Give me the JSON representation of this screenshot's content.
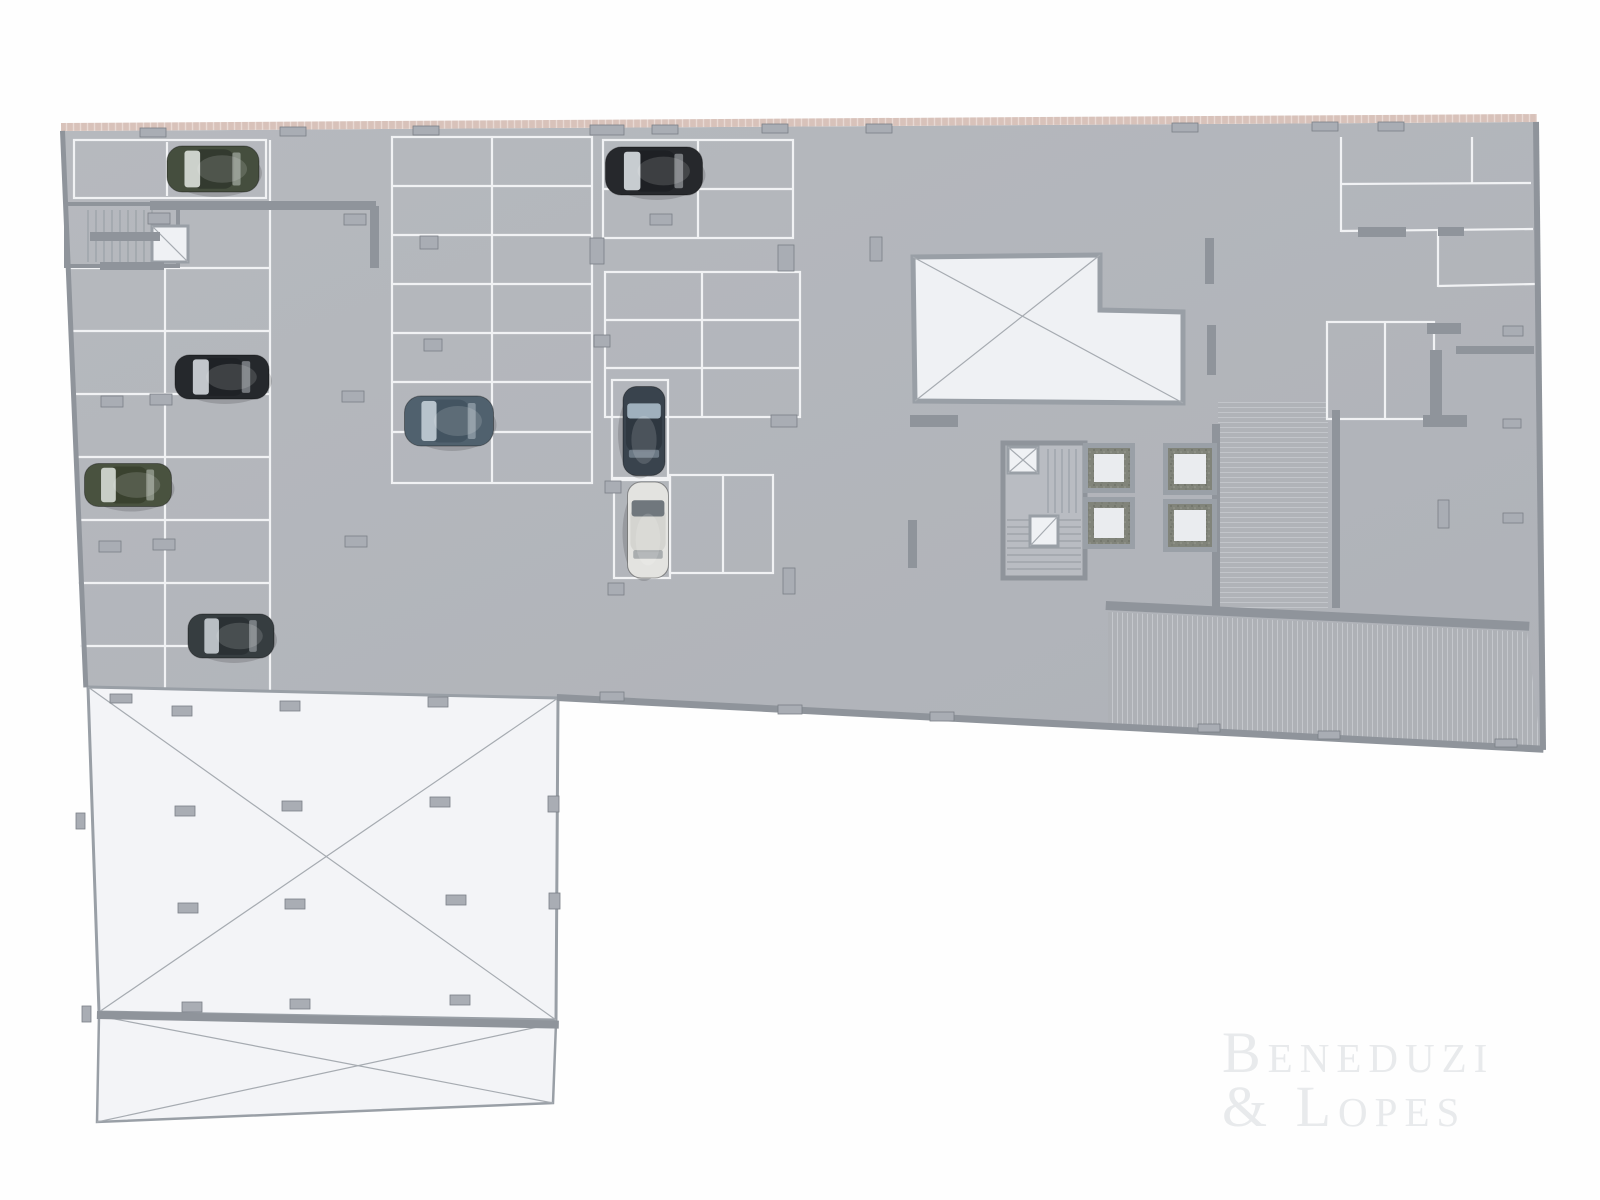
{
  "watermark": {
    "line1": "Beneduzi",
    "line2": "& Lopes"
  },
  "colors": {
    "line": "#f1f2f4",
    "wall": "#8f949b",
    "stub_fill": "#a9adb4",
    "stub_stroke": "#7a7f86",
    "diag": "#a6abb1",
    "void_fill": "#eff1f4",
    "void_stroke": "#999fa6",
    "panel_fill": "#f3f4f7",
    "tread": "#9aa0a6",
    "elevator_wall": "#9aa0a7",
    "elevator_floor": "#eaecef",
    "perimeter_pink": "#d8c2ba",
    "watermark_gray": "#e8eaec"
  },
  "plan": {
    "floor": "62,131 1534,122 1541,749 557,697 85,686",
    "topwall": [
      61,
      123,
      1476,
      8,
      -0.35
    ],
    "bands": [
      {
        "p": "1108,612 1527,632 1541,749 1108,725",
        "pat": "hatchV"
      },
      {
        "p": "1218,402 1328,402 1328,610 1218,610",
        "pat": "hatchH"
      }
    ],
    "lines": [
      [
        167,
        142,
        167,
        196
      ],
      [
        270,
        140,
        270,
        690
      ],
      [
        165,
        268,
        165,
        690
      ],
      [
        68,
        268,
        270,
        268
      ],
      [
        70,
        331,
        270,
        331
      ],
      [
        72,
        394,
        270,
        394
      ],
      [
        74,
        457,
        270,
        457
      ],
      [
        76,
        520,
        270,
        520
      ],
      [
        78,
        583,
        270,
        583
      ],
      [
        80,
        646,
        270,
        646
      ],
      [
        492,
        137,
        492,
        483
      ],
      [
        392,
        186,
        592,
        186
      ],
      [
        392,
        235,
        592,
        235
      ],
      [
        392,
        284,
        592,
        284
      ],
      [
        392,
        333,
        592,
        333
      ],
      [
        392,
        382,
        592,
        382
      ],
      [
        392,
        432,
        592,
        432
      ],
      [
        698,
        140,
        698,
        238
      ],
      [
        603,
        189,
        793,
        189
      ],
      [
        702,
        272,
        702,
        417
      ],
      [
        605,
        320,
        800,
        320
      ],
      [
        605,
        368,
        800,
        368
      ],
      [
        723,
        475,
        723,
        573
      ],
      [
        1341,
        137,
        1341,
        232
      ],
      [
        1472,
        137,
        1472,
        184
      ],
      [
        1341,
        184,
        1531,
        183
      ],
      [
        1341,
        231,
        1533,
        229
      ],
      [
        1438,
        231,
        1438,
        287
      ],
      [
        1438,
        286,
        1535,
        284
      ],
      [
        1385,
        322,
        1385,
        419
      ]
    ],
    "stalls": [
      [
        74,
        140,
        192,
        58
      ],
      [
        392,
        137,
        200,
        346
      ],
      [
        603,
        140,
        190,
        98
      ],
      [
        605,
        272,
        195,
        145
      ],
      [
        612,
        380,
        56,
        100
      ],
      [
        614,
        478,
        56,
        100
      ],
      [
        670,
        475,
        103,
        98
      ],
      [
        1327,
        322,
        107,
        97
      ]
    ],
    "rooms": [
      {
        "r": [
          66,
          204,
          112,
          62
        ],
        "sw": 4,
        "fill": "none"
      },
      {
        "r": [
          1003,
          443,
          82,
          135
        ],
        "sw": 5,
        "fill": "#b9bcc2"
      }
    ],
    "treads": [
      {
        "x": 88,
        "y": 210,
        "step": 8,
        "count": 9,
        "dir": "v",
        "len": 52
      },
      {
        "x": 1007,
        "y": 520,
        "step": 7,
        "count": 8,
        "dir": "h",
        "len": 74
      },
      {
        "x": 1048,
        "y": 449,
        "step": 7,
        "count": 5,
        "dir": "v",
        "len": 64
      }
    ],
    "voids": [
      {
        "p": "913,257 1100,255 1100,310 1183,312 1183,403 915,401",
        "sw": 5,
        "d": [
          [
            913,
            257,
            1183,
            403
          ],
          [
            1100,
            255,
            915,
            401
          ]
        ]
      },
      {
        "p": "152,226 188,226 188,262 152,262",
        "sw": 3,
        "d": [
          [
            152,
            226,
            188,
            262
          ]
        ]
      },
      {
        "p": "1008,447 1038,447 1038,473 1008,473",
        "sw": 3,
        "d": [
          [
            1008,
            447,
            1038,
            473
          ],
          [
            1038,
            447,
            1008,
            473
          ]
        ]
      },
      {
        "p": "1030,516 1058,516 1058,546 1030,546",
        "sw": 3,
        "d": [
          [
            1030,
            546,
            1058,
            516
          ]
        ]
      }
    ],
    "panels": [
      {
        "p": "88,687 558,698 556,1020 99,1012",
        "sw": 3,
        "d": [
          [
            88,
            687,
            556,
            1020
          ],
          [
            558,
            698,
            99,
            1012
          ]
        ]
      },
      {
        "p": "99,1016 556,1023 553,1103 97,1122",
        "sw": 2.5,
        "d": [
          [
            99,
            1016,
            553,
            1103
          ],
          [
            556,
            1023,
            97,
            1122
          ]
        ]
      }
    ],
    "walls": [
      [
        1358,
        227,
        48,
        10
      ],
      [
        1438,
        227,
        26,
        9
      ],
      [
        1427,
        323,
        34,
        11
      ],
      [
        1456,
        346,
        78,
        8
      ],
      [
        1430,
        350,
        12,
        70
      ],
      [
        1423,
        415,
        44,
        12
      ],
      [
        1205,
        238,
        9,
        46
      ],
      [
        1207,
        325,
        9,
        50
      ],
      [
        910,
        415,
        48,
        12
      ],
      [
        908,
        520,
        9,
        48
      ],
      [
        1106,
        601,
        424,
        9,
        2.8
      ],
      [
        1212,
        424,
        8,
        186
      ],
      [
        1332,
        410,
        8,
        198
      ],
      [
        557,
        694,
        988,
        7,
        3.0
      ],
      [
        60,
        131,
        5,
        557,
        -2.4
      ],
      [
        1533,
        122,
        6,
        628,
        -0.64
      ],
      [
        150,
        201,
        226,
        9
      ],
      [
        370,
        206,
        9,
        62
      ],
      [
        90,
        232,
        70,
        9
      ],
      [
        100,
        262,
        64,
        8
      ],
      [
        97,
        1011,
        462,
        8,
        1.2
      ]
    ],
    "stubs": [
      [
        140,
        128,
        26,
        9
      ],
      [
        280,
        127,
        26,
        9
      ],
      [
        413,
        126,
        26,
        9
      ],
      [
        590,
        125,
        34,
        10
      ],
      [
        652,
        125,
        26,
        9
      ],
      [
        762,
        124,
        26,
        9
      ],
      [
        866,
        124,
        26,
        9
      ],
      [
        1172,
        123,
        26,
        9
      ],
      [
        1312,
        122,
        26,
        9
      ],
      [
        1378,
        122,
        26,
        9
      ],
      [
        148,
        213,
        22,
        11
      ],
      [
        344,
        214,
        22,
        11
      ],
      [
        650,
        214,
        22,
        11
      ],
      [
        101,
        396,
        22,
        11
      ],
      [
        150,
        394,
        22,
        11
      ],
      [
        342,
        391,
        22,
        11
      ],
      [
        420,
        236,
        18,
        13
      ],
      [
        424,
        339,
        18,
        12
      ],
      [
        99,
        541,
        22,
        11
      ],
      [
        153,
        539,
        22,
        11
      ],
      [
        345,
        536,
        22,
        11
      ],
      [
        590,
        238,
        14,
        26
      ],
      [
        594,
        335,
        16,
        12
      ],
      [
        605,
        481,
        16,
        12
      ],
      [
        608,
        583,
        16,
        12
      ],
      [
        783,
        568,
        12,
        26
      ],
      [
        778,
        245,
        16,
        26
      ],
      [
        771,
        415,
        26,
        12
      ],
      [
        870,
        237,
        12,
        24
      ],
      [
        1503,
        326,
        20,
        10
      ],
      [
        1503,
        513,
        20,
        10
      ],
      [
        1438,
        500,
        11,
        28
      ],
      [
        1503,
        419,
        18,
        9
      ],
      [
        600,
        692,
        24,
        9
      ],
      [
        778,
        705,
        24,
        9
      ],
      [
        930,
        712,
        24,
        9
      ],
      [
        1198,
        724,
        22,
        8
      ],
      [
        1318,
        731,
        22,
        8
      ],
      [
        1495,
        739,
        22,
        8
      ],
      [
        110,
        694,
        22,
        9
      ],
      [
        548,
        796,
        11,
        16
      ],
      [
        549,
        893,
        11,
        16
      ],
      [
        76,
        813,
        9,
        16
      ],
      [
        82,
        1006,
        9,
        16
      ],
      [
        172,
        706,
        20,
        10
      ],
      [
        280,
        701,
        20,
        10
      ],
      [
        428,
        697,
        20,
        10
      ],
      [
        175,
        806,
        20,
        10
      ],
      [
        282,
        801,
        20,
        10
      ],
      [
        430,
        797,
        20,
        10
      ],
      [
        178,
        903,
        20,
        10
      ],
      [
        285,
        899,
        20,
        10
      ],
      [
        446,
        895,
        20,
        10
      ],
      [
        182,
        1002,
        20,
        10
      ],
      [
        290,
        999,
        20,
        10
      ],
      [
        450,
        995,
        20,
        10
      ]
    ],
    "elevators": [
      [
        1083,
        443,
        52,
        50
      ],
      [
        1083,
        497,
        52,
        52
      ],
      [
        1163,
        443,
        54,
        52
      ],
      [
        1163,
        499,
        54,
        53
      ]
    ],
    "cars": [
      [
        213,
        169,
        92,
        46,
        0,
        "#454e3e",
        "#333a2f",
        "#ccd1cb"
      ],
      [
        654,
        171,
        97,
        48,
        0,
        "#26282c",
        "#1e2024",
        "#c7ccd0"
      ],
      [
        222,
        377,
        94,
        44,
        0,
        "#25282c",
        "#1f2226",
        "#c2c6cb"
      ],
      [
        128,
        485,
        87,
        43,
        0,
        "#49523f",
        "#3a422f",
        "#c8cec6"
      ],
      [
        449,
        421,
        89,
        50,
        0,
        "#50616e",
        "#435461",
        "#b7c3cc"
      ],
      [
        644,
        431,
        89,
        42,
        90,
        "#39434d",
        "#2e3740",
        "#9fb0bd"
      ],
      [
        648,
        530,
        96,
        41,
        90,
        "#e3e3e0",
        "#d4d4d0",
        "#70777d"
      ],
      [
        231,
        636,
        86,
        44,
        0,
        "#363d40",
        "#2b3134",
        "#b9bfc4"
      ]
    ]
  }
}
